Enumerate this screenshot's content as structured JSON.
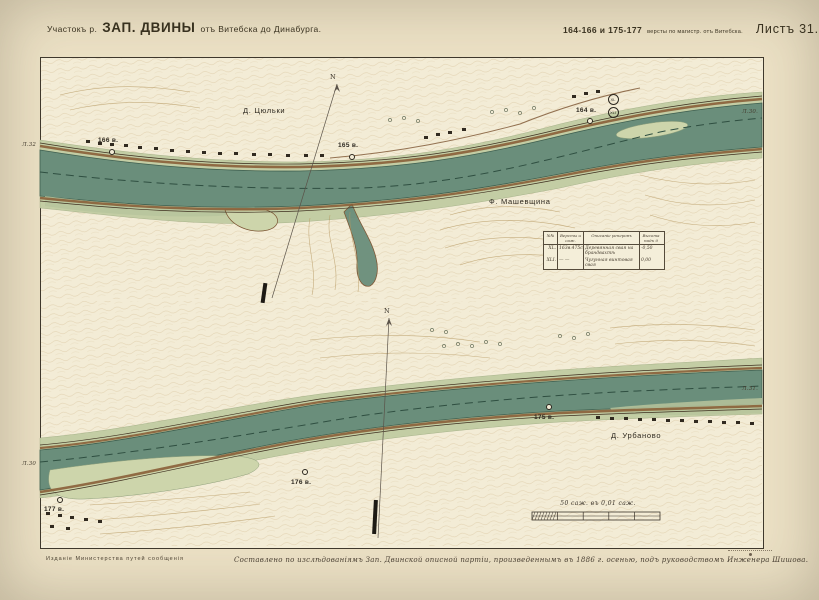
{
  "header": {
    "title_prefix": "Участокъ р.",
    "title_main": "ЗАП. ДВИНЫ",
    "title_suffix": "отъ Витебска до Динабурга.",
    "versts": "164-166 и 175-177",
    "versts_note": "версты по магистр. отъ Витебска.",
    "sheet_label": "Листъ 31."
  },
  "footer": {
    "publisher": "Изданіе Министерства путей сообщенія",
    "credit": "Составлено по изслѣдованіямъ Зап. Двинской описной партіи, произведеннымъ въ 1886 г. осенью, подъ руководствомъ Инженера Шишова."
  },
  "scale_bar": {
    "caption": "50 саж. въ 0,01 саж."
  },
  "benchmark_table": {
    "headers": [
      "№№",
      "Версты и саж.",
      "Описаніе реперовъ",
      "Высота надъ 0"
    ],
    "rows": [
      {
        "num": "XL.",
        "verst": "163в.475с.",
        "desc": "Деревянная свая на брандвахтѣ",
        "height": "-0,50"
      },
      {
        "num": "XLI.",
        "verst": "—  —",
        "desc": "Чугунная винтовая свая",
        "height": "0,00"
      }
    ]
  },
  "colors": {
    "paper": "#ece1c5",
    "map_paper": "#f3ecd6",
    "water": "#6a8e7b",
    "shoal": "#c3cda4",
    "bank_brown": "#8a5f38",
    "ink": "#2e2920"
  },
  "map_labels": [
    {
      "name": "village-label-tsyulki",
      "text": "Д. Цюльки",
      "x": 243,
      "y": 106,
      "cls": ""
    },
    {
      "name": "farm-label-mashevshchina",
      "text": "Ф. Машевщина",
      "x": 489,
      "y": 197,
      "cls": ""
    },
    {
      "name": "village-label-urbanovo",
      "text": "Д. Урбаново",
      "x": 611,
      "y": 431,
      "cls": ""
    },
    {
      "name": "sheet-ref-upper-left",
      "text": "Л.32",
      "x": 22,
      "y": 142,
      "cls": "edge"
    },
    {
      "name": "sheet-ref-upper-right",
      "text": "Л.30.",
      "x": 742,
      "y": 109,
      "cls": "edge"
    },
    {
      "name": "sheet-ref-lower-left",
      "text": "Л.30",
      "x": 22,
      "y": 461,
      "cls": "edge"
    },
    {
      "name": "sheet-ref-lower-right",
      "text": "Л.31.",
      "x": 742,
      "y": 386,
      "cls": "edge"
    },
    {
      "name": "north-label-upper",
      "text": "N",
      "x": 330,
      "y": 73,
      "cls": "north"
    },
    {
      "name": "north-label-lower",
      "text": "N",
      "x": 384,
      "y": 307,
      "cls": "north"
    }
  ],
  "verst_markers": [
    {
      "name": "verst-166",
      "text": "166 в.",
      "cx": 112,
      "cy": 152,
      "lx": 98,
      "ly": 137
    },
    {
      "name": "verst-165",
      "text": "165 в.",
      "cx": 352,
      "cy": 157,
      "lx": 338,
      "ly": 142
    },
    {
      "name": "verst-164",
      "text": "164 в.",
      "cx": 590,
      "cy": 121,
      "lx": 576,
      "ly": 107
    },
    {
      "name": "verst-175",
      "text": "175 в.",
      "cx": 549,
      "cy": 407,
      "lx": 534,
      "ly": 414
    },
    {
      "name": "verst-176",
      "text": "176 в.",
      "cx": 305,
      "cy": 472,
      "lx": 291,
      "ly": 479
    },
    {
      "name": "verst-177",
      "text": "177 в.",
      "cx": 60,
      "cy": 500,
      "lx": 44,
      "ly": 506
    }
  ],
  "benchmarks": [
    {
      "name": "benchmark-xl",
      "text": "XL",
      "cx": 613,
      "cy": 99
    },
    {
      "name": "benchmark-xli",
      "text": "XLI",
      "cx": 613,
      "cy": 112
    }
  ]
}
